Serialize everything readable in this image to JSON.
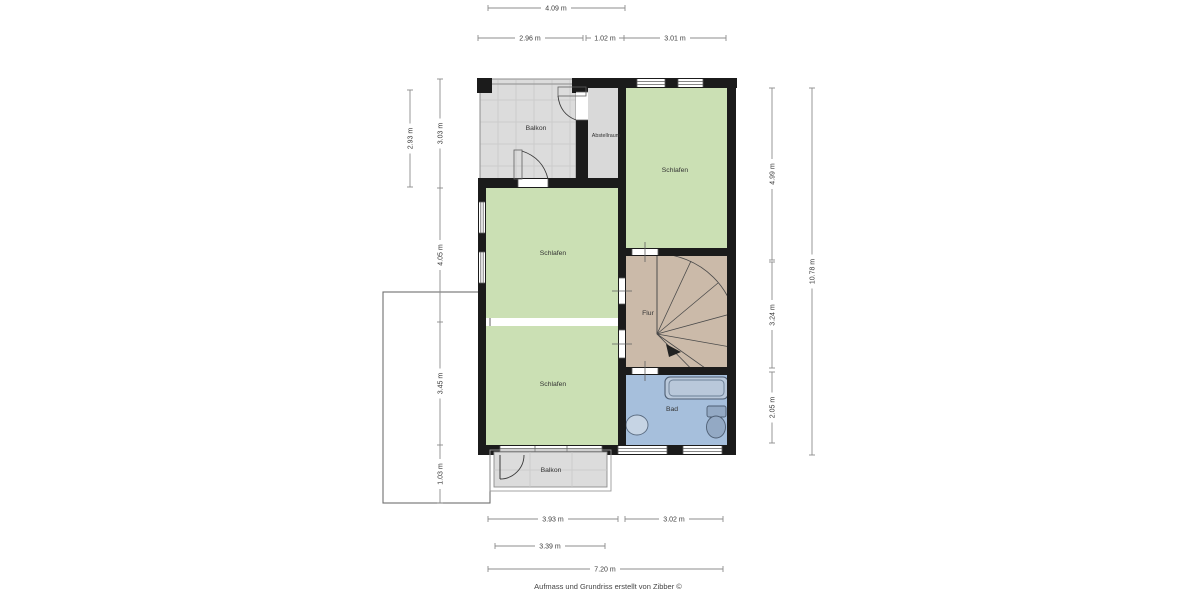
{
  "colors": {
    "wall": "#1b1b1b",
    "bedroom_fill": "#cbe0b4",
    "balcony_fill": "#dcdcdc",
    "storage_fill": "#d9d9d9",
    "hall_fill": "#cbbaa9",
    "bath_fill": "#a6bfdc",
    "tub_fill": "#b9c8da",
    "fixture_fill": "#93a9c4",
    "stair_fill": "#ffffff"
  },
  "rooms": {
    "balkon_top": "Balkon",
    "abstellraum": "Abstellraum",
    "schlafen_top": "Schlafen",
    "schlafen_mid": "Schlafen",
    "flur": "Flur",
    "schlafen_bottom": "Schlafen",
    "bad": "Bad",
    "balkon_bottom": "Balkon"
  },
  "dimensions": {
    "top": [
      "4.09 m",
      "2.96 m",
      "1.02 m",
      "3.01 m"
    ],
    "left_outer": [
      "2.93 m"
    ],
    "left_inner": [
      "3.03 m",
      "4.05 m",
      "3.45 m",
      "1.03 m"
    ],
    "right_inner": [
      "4.99 m",
      "3.24 m",
      "2.05 m"
    ],
    "right_outer": [
      "10.78 m"
    ],
    "bottom_row1": [
      "3.93 m",
      "3.02 m"
    ],
    "bottom_row2": [
      "3.39 m"
    ],
    "bottom_row3": [
      "7.20 m"
    ]
  },
  "footer": "Aufmass und Grundriss erstellt von Zibber ©"
}
